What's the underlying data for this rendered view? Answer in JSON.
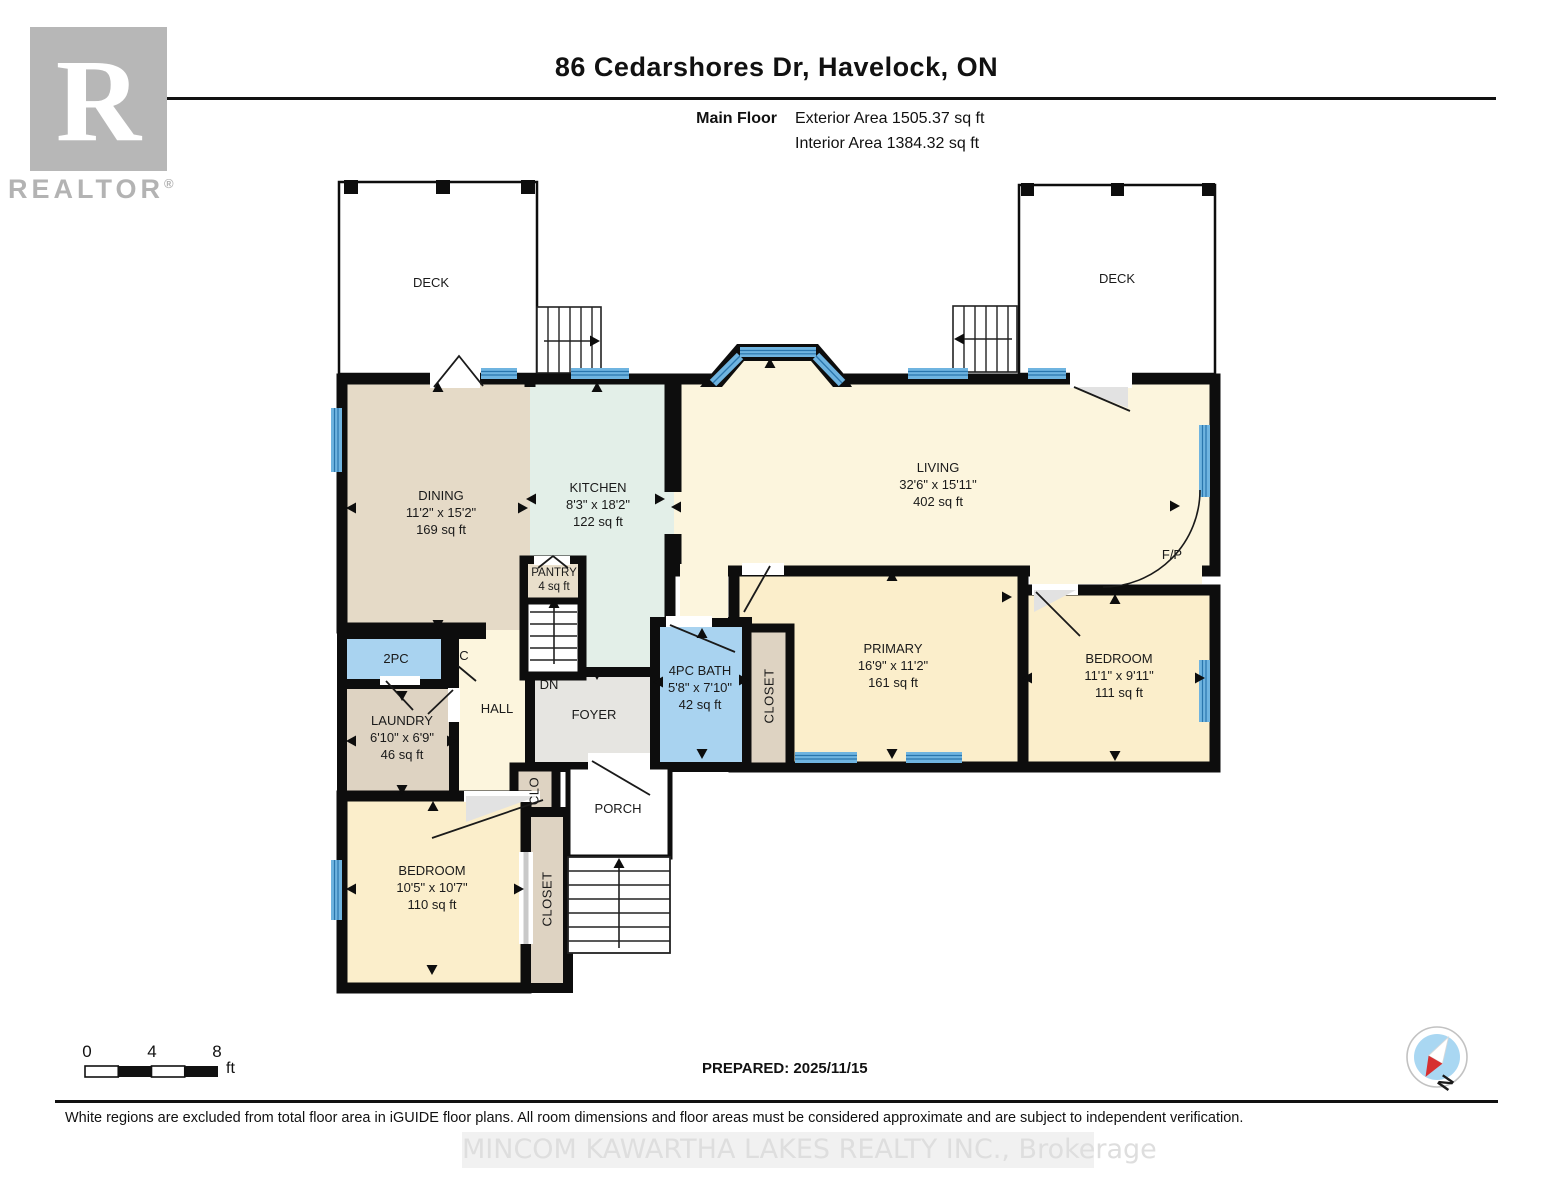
{
  "header": {
    "title": "86 Cedarshores Dr, Havelock, ON",
    "floor_label": "Main Floor",
    "exterior_area": "Exterior Area 1505.37 sq ft",
    "interior_area": "Interior Area 1384.32 sq ft"
  },
  "logo": {
    "letter": "R",
    "brand": "REALTOR",
    "registered": "®"
  },
  "rooms": {
    "deck_left": {
      "name": "DECK"
    },
    "deck_right": {
      "name": "DECK"
    },
    "dining": {
      "name": "DINING",
      "dims": "11'2\" x 15'2\"",
      "area": "169 sq ft"
    },
    "kitchen": {
      "name": "KITCHEN",
      "dims": "8'3\" x 18'2\"",
      "area": "122 sq ft"
    },
    "living": {
      "name": "LIVING",
      "dims": "32'6\" x 15'11\"",
      "area": "402 sq ft"
    },
    "pantry": {
      "name": "PANTRY",
      "area": "4 sq ft"
    },
    "primary": {
      "name": "PRIMARY",
      "dims": "16'9\" x 11'2\"",
      "area": "161 sq ft"
    },
    "bath": {
      "name": "4PC BATH",
      "dims": "5'8\" x 7'10\"",
      "area": "42 sq ft"
    },
    "bedroom_right": {
      "name": "BEDROOM",
      "dims": "11'1\" x 9'11\"",
      "area": "111 sq ft"
    },
    "bedroom_bottom": {
      "name": "BEDROOM",
      "dims": "10'5\" x 10'7\"",
      "area": "110 sq ft"
    },
    "laundry": {
      "name": "LAUNDRY",
      "dims": "6'10\" x 6'9\"",
      "area": "46 sq ft"
    },
    "two_pc": {
      "name": "2PC"
    },
    "closet_c": {
      "name": "C"
    },
    "hall": {
      "name": "HALL"
    },
    "foyer": {
      "name": "FOYER"
    },
    "stairs_down": {
      "name": "DN"
    },
    "clo": {
      "name": "CLO"
    },
    "closet_mid": {
      "name": "CLOSET"
    },
    "closet_bottom": {
      "name": "CLOSET"
    },
    "porch": {
      "name": "PORCH"
    },
    "fireplace": {
      "name": "F/P"
    }
  },
  "scale_bar": {
    "t0": "0",
    "t4": "4",
    "t8": "8",
    "unit": "ft"
  },
  "footer": {
    "prepared": "PREPARED: 2025/11/15",
    "disclaimer": "White regions are excluded from total floor area in iGUIDE floor plans. All room dimensions and floor areas must be considered approximate and are subject to independent verification.",
    "watermark": "MINCOM KAWARTHA LAKES REALTY INC., Brokerage"
  },
  "compass": {
    "north": "N"
  },
  "colors": {
    "wall": "#0d0d0d",
    "window_blue": "#6fb4e0",
    "window_dark": "#2a76ad",
    "dining_beige": "#e5dac7",
    "closet_beige": "#ded3c2",
    "kitchen_mint": "#e3efe8",
    "living_cream": "#fcf5dd",
    "bedroom_yellow": "#fbeecb",
    "bath_blue": "#a9d3f0",
    "foyer_gray": "#e6e5e1",
    "compass_blue": "#a9d7f2",
    "needle_red": "#d63030"
  }
}
